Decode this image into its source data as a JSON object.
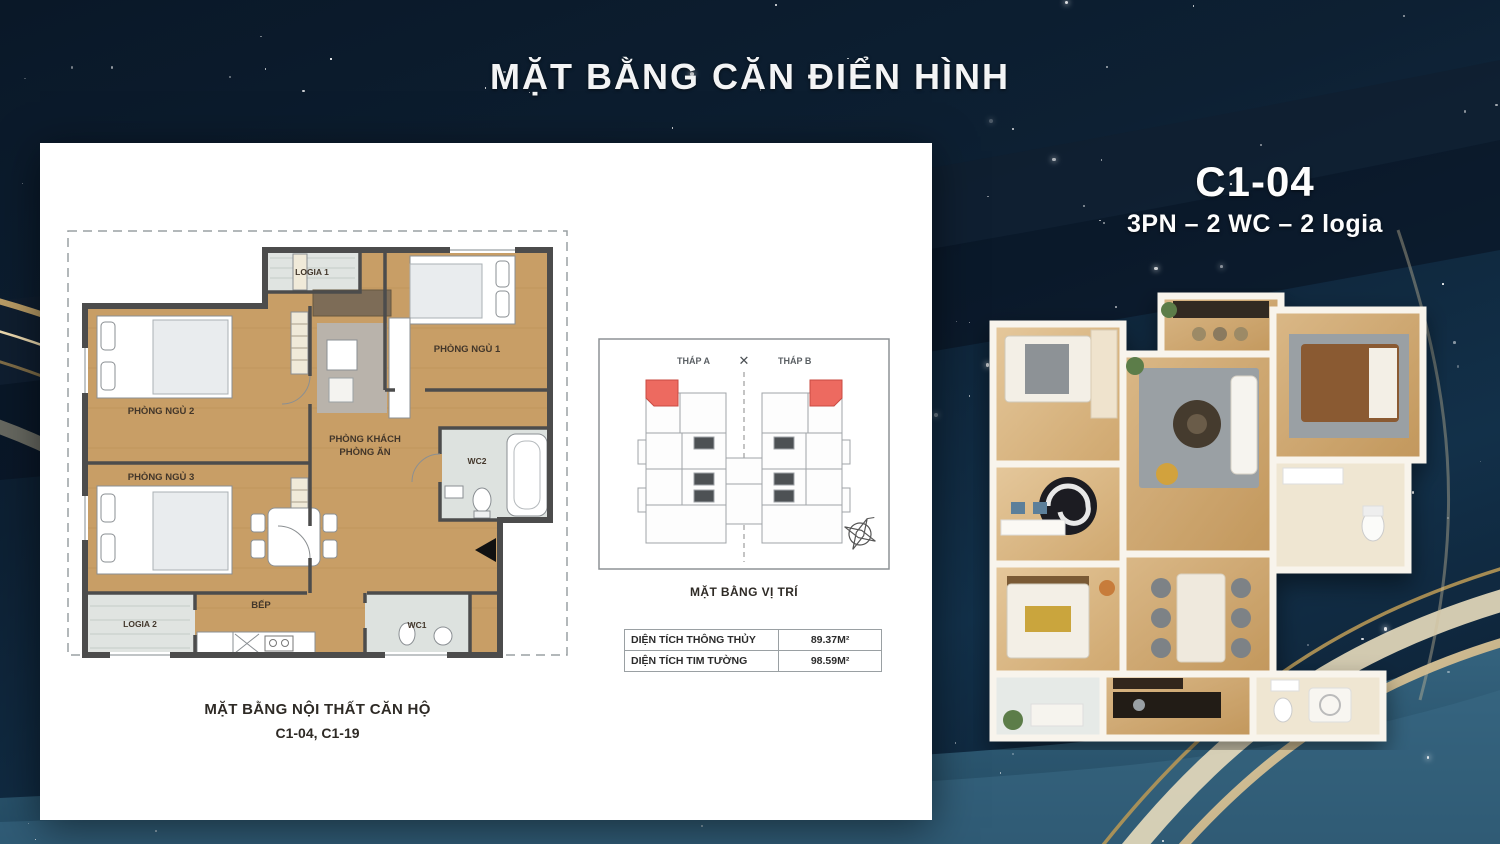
{
  "slide": {
    "title": "MẶT BẰNG CĂN ĐIỂN HÌNH"
  },
  "unit": {
    "code": "C1-04",
    "spec": "3PN – 2 WC – 2 logia"
  },
  "plan2d": {
    "caption_line1": "MẶT BẰNG NỘI THẤT CĂN HỘ",
    "caption_line2": "C1-04, C1-19",
    "rooms": {
      "logia1": "LOGIA 1",
      "bedroom1": "PHÒNG NGỦ 1",
      "bedroom2": "PHÒNG NGỦ 2",
      "bedroom3": "PHÒNG NGỦ 3",
      "living_line1": "PHÒNG KHÁCH",
      "living_line2": "PHÒNG ĂN",
      "wc2": "WC2",
      "kitchen": "BẾP",
      "wc1": "WC1",
      "logia2": "LOGIA 2"
    }
  },
  "location_plan": {
    "tower_a": "THÁP A",
    "tower_b": "THÁP B",
    "caption": "MẶT BẰNG VỊ TRÍ"
  },
  "icons": {
    "tower_divider": "✕"
  },
  "area_table": {
    "rows": [
      {
        "label": "DIỆN TÍCH THÔNG THỦY",
        "value": "89.37M²"
      },
      {
        "label": "DIỆN TÍCH TIM TƯỜNG",
        "value": "98.59M²"
      }
    ]
  },
  "colors": {
    "background_navy": "#0d2033",
    "accent_gold": "#c9ad7a",
    "highlight_red": "#ed6a60",
    "wood": "#c89e66",
    "card_white": "#ffffff"
  }
}
